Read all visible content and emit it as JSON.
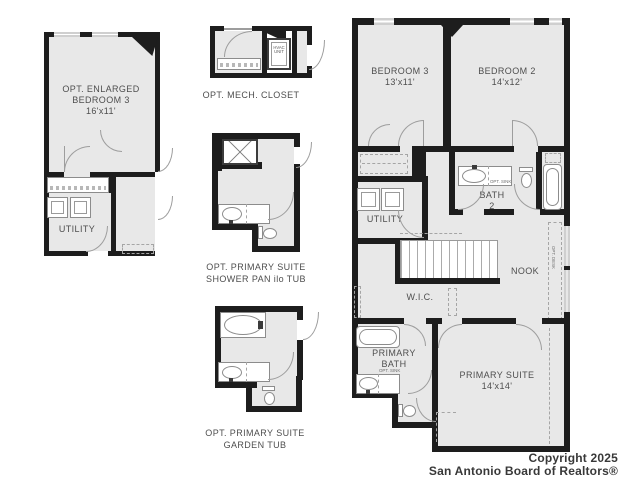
{
  "colors": {
    "wall": "#1d1d1d",
    "room_fill": "#e8e8e8",
    "label_text": "#4e4e4e"
  },
  "options": {
    "enlarged_bedroom3": {
      "title1": "OPT. ENLARGED",
      "title2": "BEDROOM 3",
      "dims": "16'x11'",
      "utility": "UTILITY"
    },
    "mech_closet": {
      "caption": "OPT. MECH. CLOSET",
      "hvac1": "HVAC",
      "hvac2": "UNIT"
    },
    "shower_pan": {
      "caption1": "OPT. PRIMARY SUITE",
      "caption2": "SHOWER PAN ilo TUB"
    },
    "garden_tub": {
      "caption1": "OPT. PRIMARY SUITE",
      "caption2": "GARDEN TUB"
    }
  },
  "main": {
    "bedroom3": {
      "name": "BEDROOM 3",
      "dims": "13'x11'"
    },
    "bedroom2": {
      "name": "BEDROOM 2",
      "dims": "14'x12'"
    },
    "bath2": {
      "name1": "BATH",
      "name2": "2",
      "opt_sink": "OPT. SINK"
    },
    "utility": "UTILITY",
    "nook": "NOOK",
    "opt_desk": "OPT. DESK",
    "wic": "W.I.C.",
    "primary_bath": {
      "name1": "PRIMARY",
      "name2": "BATH",
      "opt_sink": "OPT. SINK"
    },
    "primary_suite": {
      "name": "PRIMARY SUITE",
      "dims": "14'x14'"
    }
  },
  "footer": {
    "line1": "Copyright 2025",
    "line2": "San Antonio Board of Realtors®"
  }
}
